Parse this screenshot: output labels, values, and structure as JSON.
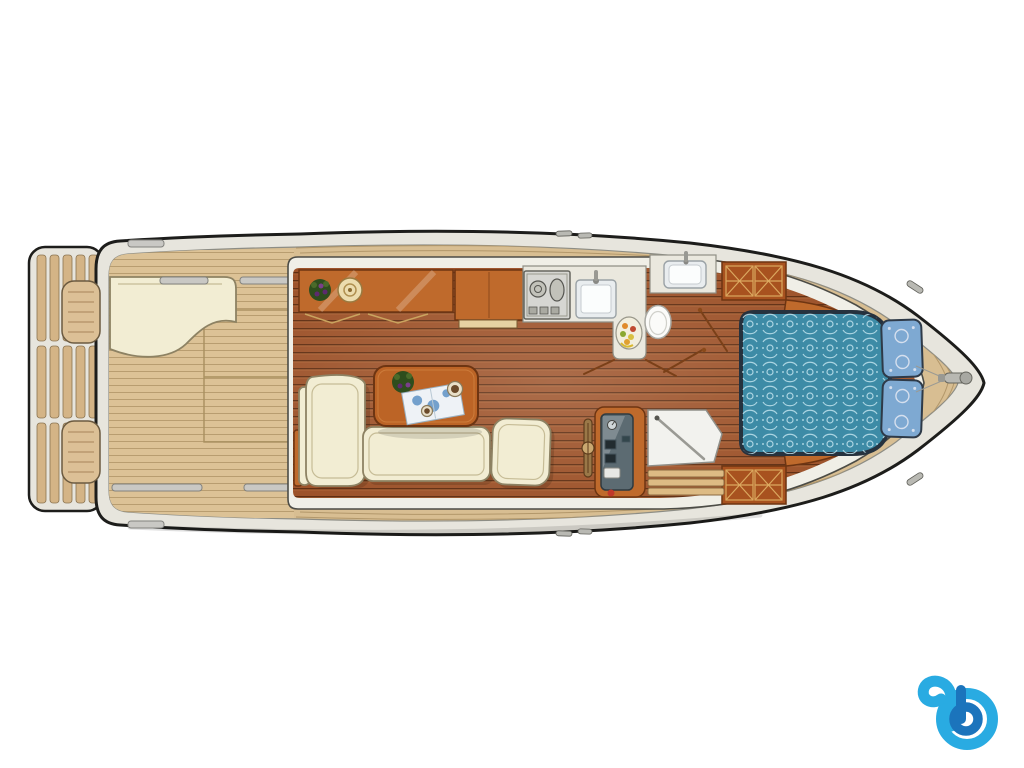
{
  "meta": {
    "type": "boat-deck-floorplan-illustration",
    "background": "#ffffff"
  },
  "palette": {
    "hull-line": "#1d1d1b",
    "hull-band": "#e7e5dd",
    "hull-band-edge": "#8d8d85",
    "deck-teak": "#d8be92",
    "deck-line": "#b2976a",
    "cockpit-teak": "#dcc296",
    "wall-band": "#f0efe7",
    "wall-edge": "#4c4c46",
    "floor-base": "#9c5128",
    "floor-seam": "#5e2c10",
    "floor-hi": "#c67b45",
    "cabinet-wood": "#bf6a2c",
    "cabinet-dark": "#6e3512",
    "wardrobe-wood": "#a8521f",
    "inlay-gold": "#dba85f",
    "counter": "#eae8de",
    "appliance-grey": "#d6d6d2",
    "sink-white": "#f4f6f6",
    "sofa-cream": "#f2edd3",
    "sofa-edge": "#8d8263",
    "table-wood": "#bc6426",
    "bed-blue": "#3d8ba6",
    "bed-pattern": "#bfe2ec",
    "bed-rim": "#26323e",
    "pillow-blue": "#7ea9d2",
    "pillow-pattern": "#d5dfee",
    "helm-panel": "#5c6b72",
    "white-panel": "#f2f2ee",
    "steel-grey": "#c9c8c4",
    "steel-edge": "#82827e",
    "plant-green": "#2e4d1d",
    "plant-purple": "#5c2a6e",
    "logo-light": "#29abe2",
    "logo-dark": "#1b74bc"
  },
  "floorplan": {
    "labels": {
      "boat": "Motor yacht deck floor plan, top view, bow to the right",
      "swim_platform": "Swim platform with teak slats",
      "aft_deck": "Aft deck cockpit with teak planking",
      "bench_cushion": "Aft deck seat cushion",
      "deck_hatch": "Aft deck engine hatch",
      "grab_rail": "Deck grab rail",
      "saloon": "Saloon with wooden plank floor",
      "sideboard": "Saloon sideboard cabinet",
      "plant": "Potted plant",
      "lamp": "Round table lamp",
      "upper_cabinet": "Galley cabinet",
      "galley": "L-shaped galley counter",
      "stove": "Two burner gas stove",
      "sink": "Galley sink with faucet",
      "fruit_bowl": "Fruit bowl",
      "toilet": "Toilet",
      "head_sink": "Bathroom washbasin counter",
      "sofa": "Cream L-shaped sofa",
      "armchair": "Cream armchair",
      "table": "Saloon table",
      "table_plant": "Flower bouquet on table",
      "map": "Nautical chart on table",
      "cup": "Cup",
      "helm": "Helm station instrument console",
      "wheel": "Steering wheel",
      "shower": "Shower compartment",
      "steps": "Companionway steps",
      "door": "Cabin door",
      "wardrobe": "Wardrobe with inlaid doors",
      "shelf": "Forward cabin side shelf",
      "bed": "Double bed with patterned blue bedspread",
      "pillow": "Blue pillow",
      "bow_deck": "Foredeck",
      "anchor": "Anchor windlass fitting",
      "cleat": "Mooring cleat",
      "logo": "Blue letter b watermark logo"
    }
  }
}
